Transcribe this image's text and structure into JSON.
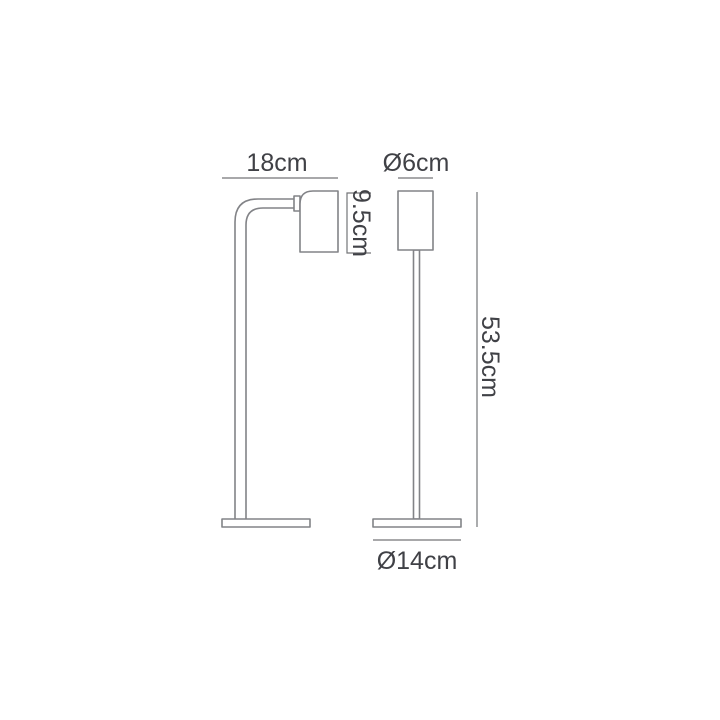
{
  "diagram": {
    "type": "product-dimension-drawing",
    "subject": "table lamp, two orthographic views (side view with curved arm, front view)",
    "background_color": "#ffffff",
    "line_color": "#828387",
    "dimension_line_color": "#737477",
    "text_color": "#404146",
    "labels": {
      "arm_depth": "18cm",
      "shade_diameter": "Ø6cm",
      "shade_height": "9.5cm",
      "total_height": "53.5cm",
      "base_diameter": "Ø14cm"
    }
  }
}
